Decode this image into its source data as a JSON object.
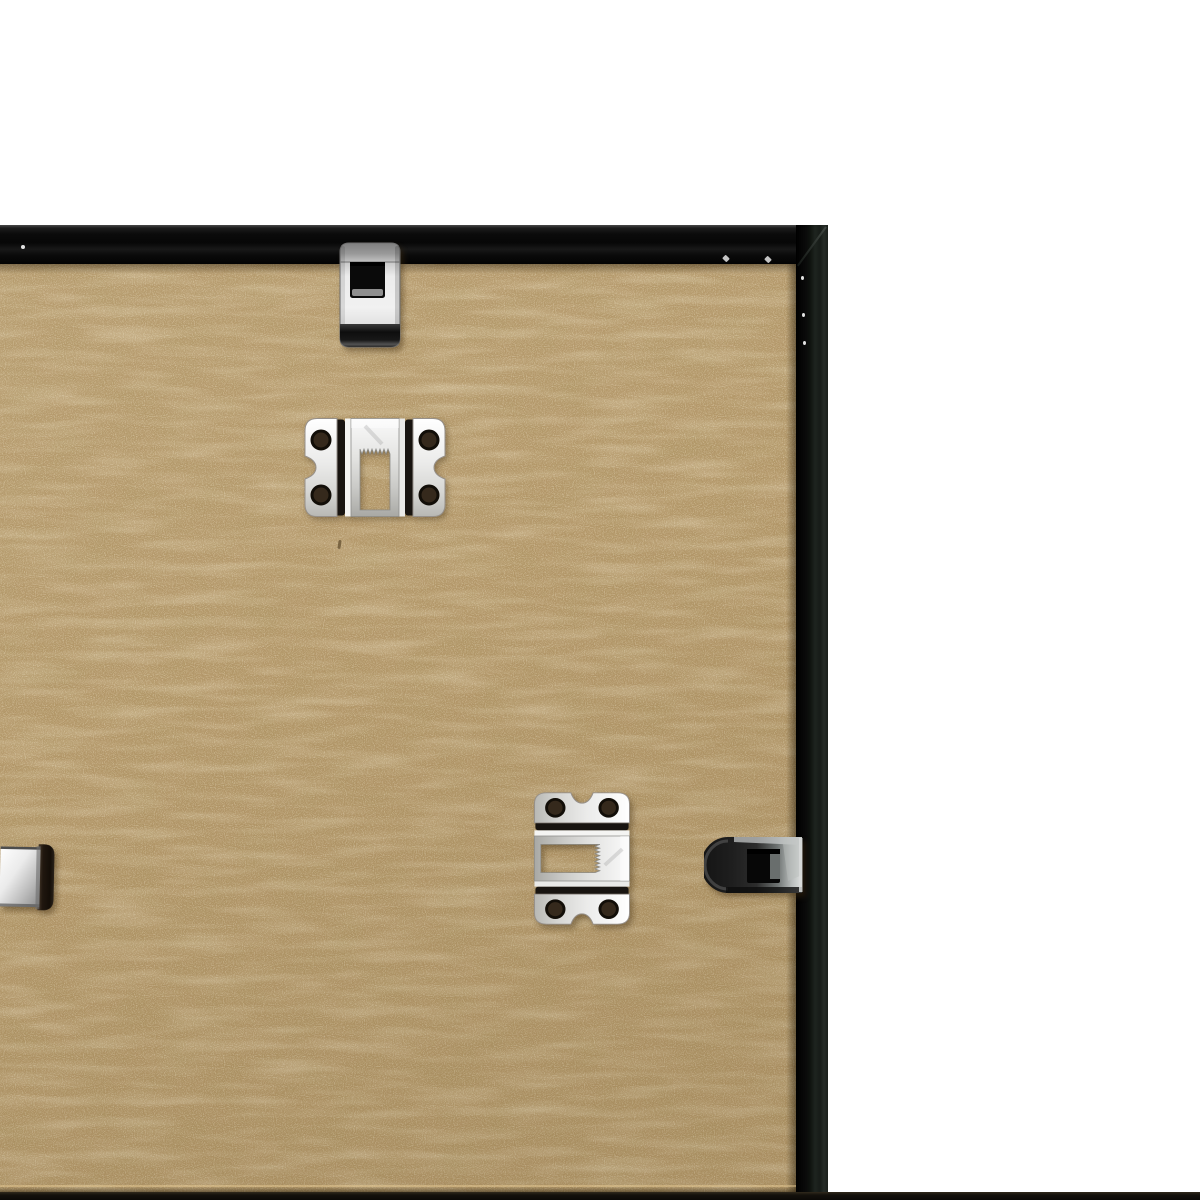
{
  "scene": {
    "type": "product photo",
    "description": "Close-up of the back of a black picture frame on a white backdrop: tan MDF backing board secured by nickel spring clips, with two sawtooth hangers mounted on the board",
    "background_color": "#ffffff"
  },
  "frame": {
    "label": "black frame moulding",
    "color": "#0b0b0b",
    "top_rail_label": "top rail inner face",
    "right_rail_label": "right rail inner face",
    "corner_label": "mitred top-right corner",
    "bottom_edge_label": "bottom frame edge sliver"
  },
  "board": {
    "label": "MDF backing board",
    "color": "#b39769",
    "edge_line_label": "board bottom edge line"
  },
  "hardware": {
    "top_clip": {
      "label": "spring clip on top rail",
      "finish": "polished nickel",
      "finish_color": "#ededed"
    },
    "top_hanger": {
      "label": "sawtooth hanger, horizontal, teeth down",
      "finish": "nickel",
      "finish_color": "#f2f2f2",
      "screw_holes": 4
    },
    "side_hanger": {
      "label": "sawtooth hanger, vertical, teeth left",
      "finish": "nickel",
      "finish_color": "#f2f2f2",
      "screw_holes": 4
    },
    "right_clip": {
      "label": "spring clip on right rail",
      "finish": "dark gunmetal nickel",
      "finish_color": "#6f7473"
    },
    "left_clip": {
      "label": "spring clip on left rail, cropped by image edge",
      "finish": "polished nickel",
      "finish_color": "#e8e8e8"
    }
  },
  "palette": {
    "white_backdrop": "#ffffff",
    "mdf_tan": "#b39769",
    "mdf_speckle_light": "#e6d4a8",
    "mdf_mottle_dark": "#8a6f42",
    "frame_black": "#0b0b0b",
    "frame_edge_green_grey": "#232925",
    "nickel_bright": "#f2f2f2",
    "nickel_shadowed": "#2b2b2b",
    "bend_shadow": "#181410",
    "cast_shadow": "rgba(64,45,16,0.45)"
  }
}
